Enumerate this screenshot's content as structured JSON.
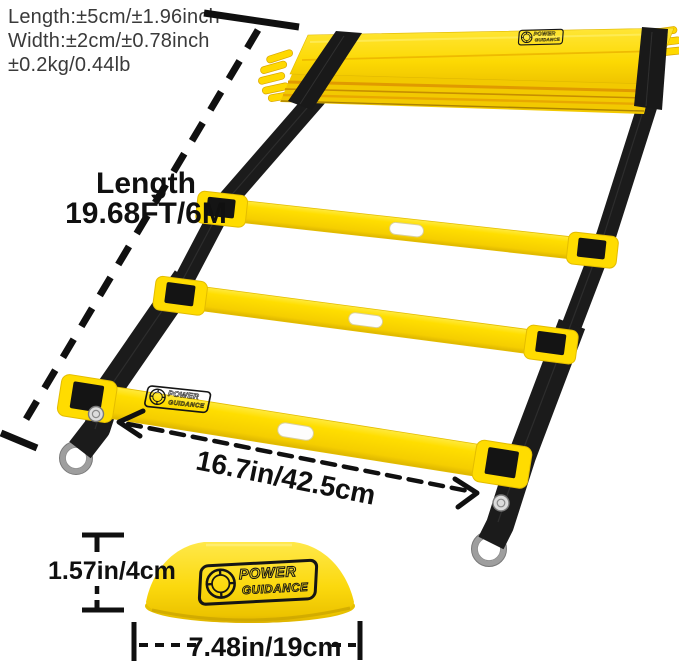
{
  "tolerances": {
    "length": "Length:±5cm/±1.96inch",
    "width": "Width:±2cm/±0.78inch",
    "weight": "±0.2kg/0.44lb"
  },
  "ladder": {
    "length_label": "Length",
    "length_value": "19.68FT/6M",
    "rung_width": "16.7in/42.5cm",
    "brand": {
      "line1": "POWER",
      "line2": "GUIDANCE"
    }
  },
  "cone": {
    "height": "1.57in/4cm",
    "width": "7.48in/19cm"
  },
  "colors": {
    "ladder_yellow": "#FFDE00",
    "ladder_yellow_dark": "#E8BC00",
    "seam_orange": "#E09A00",
    "strap_black": "#1B1B1B",
    "metal_gray": "#9E9E9E",
    "annotation_black": "#101010",
    "spec_text_gray": "#3A3A3A",
    "background": "#FFFFFF"
  }
}
